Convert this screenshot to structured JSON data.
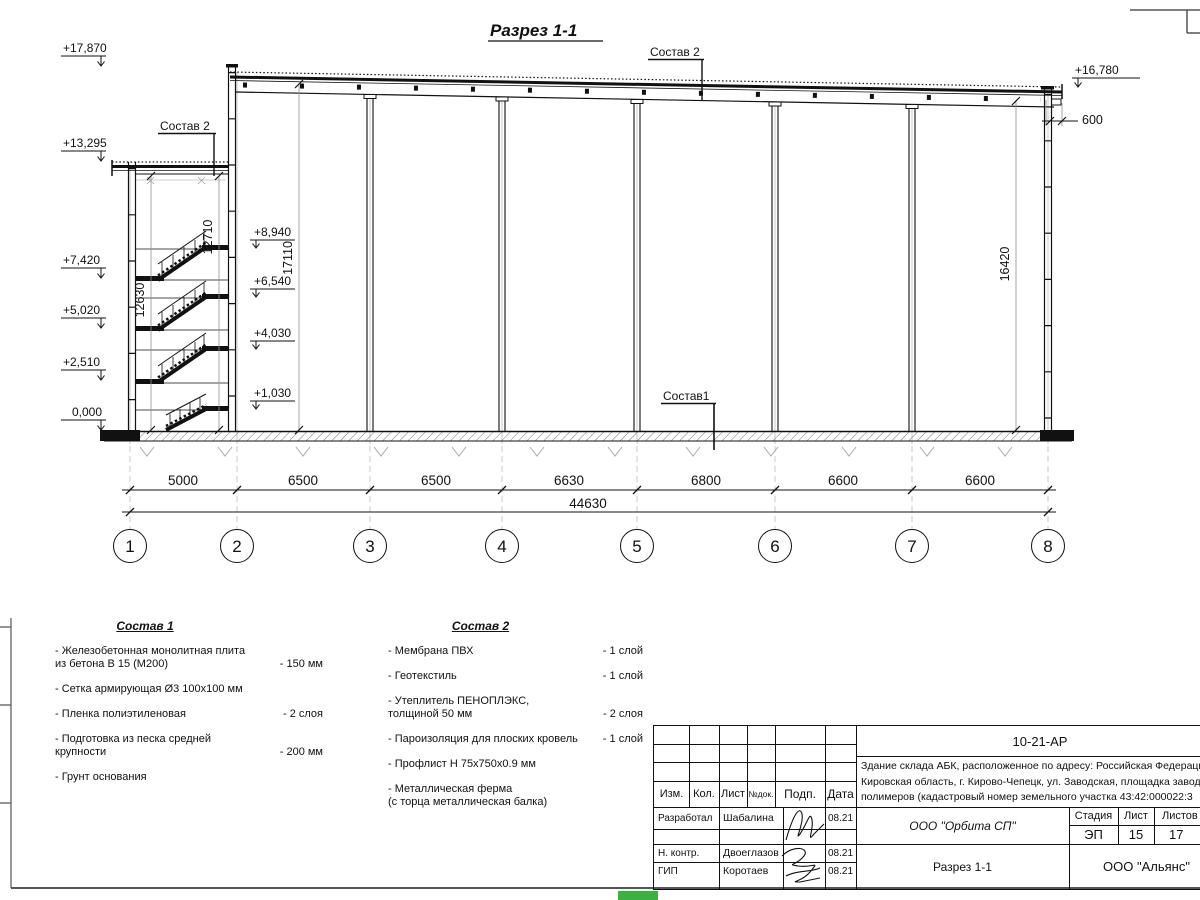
{
  "page": {
    "green_marker": "#3cb043"
  },
  "drawing": {
    "title": "Разрез 1-1",
    "callouts": {
      "sostav2_roof_main": "Состав 2",
      "sostav2_roof_abk": "Состав 2",
      "sostav1_floor": "Состав1"
    },
    "elevation_marks": {
      "left": [
        "+17,870",
        "+13,295",
        "+7,420",
        "+5,020",
        "+2,510",
        "0,000"
      ],
      "stair": [
        "+8,940",
        "+6,540",
        "+4,030",
        "+1,030"
      ],
      "right_top": "+16,780"
    },
    "dim_overhang": "600",
    "vertical_dims": {
      "stair_left": "12630",
      "stair_right": "12710",
      "hall_left": "17110",
      "hall_right": "16420"
    },
    "span_dims": [
      "5000",
      "6500",
      "6500",
      "6630",
      "6800",
      "6600",
      "6600"
    ],
    "total_dim": "44630",
    "axes": [
      "1",
      "2",
      "3",
      "4",
      "5",
      "6",
      "7",
      "8"
    ]
  },
  "notes1": {
    "heading": "Состав 1",
    "items": [
      {
        "text": "- Железобетонная  монолитная плита\nиз бетона В 15 (М200)",
        "value": "- 150 мм"
      },
      {
        "text": "- Сетка армирующая Ø3 100х100 мм",
        "value": ""
      },
      {
        "text": "- Пленка полиэтиленовая",
        "value": "-  2 слоя"
      },
      {
        "text": "- Подготовка из песка средней\nкрупности",
        "value": "- 200 мм"
      },
      {
        "text": "- Грунт основания",
        "value": ""
      }
    ]
  },
  "notes2": {
    "heading": "Состав 2",
    "items": [
      {
        "text": "- Мембрана ПВХ",
        "value": "- 1 слой"
      },
      {
        "text": "- Геотекстиль",
        "value": "- 1 слой"
      },
      {
        "text": "- Утеплитель ПЕНОПЛЭКС,\nтолщиной 50 мм",
        "value": "- 2 слоя"
      },
      {
        "text": "- Пароизоляция для плоских кровель",
        "value": "- 1 слой"
      },
      {
        "text": "- Профлист Н 75х750х0.9 мм",
        "value": ""
      },
      {
        "text": "- Металлическая ферма\n(с торца металлическая балка)",
        "value": ""
      }
    ]
  },
  "titleblock": {
    "doc_number": "10-21-АР",
    "description": "Здание склада АБК, расположенное по адресу: Российская Федерация,\nКировская область, г. Кирово-Чепецк, ул. Заводская, площадка завода\nполимеров (кадастровый номер земельного участка 43:42:000022:3",
    "rev_headers": [
      "Изм.",
      "Кол.",
      "Лист",
      "№док.",
      "Подп.",
      "Дата"
    ],
    "roles": [
      {
        "role": "Разработал",
        "name": "Шабалина",
        "date": "08.21"
      },
      {
        "role": "Н. контр.",
        "name": "Двоеглазов",
        "date": "08.21"
      },
      {
        "role": "ГИП",
        "name": "Коротаев",
        "date": "08.21"
      }
    ],
    "org": "ООО \"Орбита СП\"",
    "sheet_title": "Разрез 1-1",
    "stage_label": "Стадия",
    "sheet_label": "Лист",
    "sheets_label": "Листов",
    "stage": "ЭП",
    "sheet_num": "15",
    "sheets_total": "17",
    "contractor": "ООО \"Альянс\""
  }
}
